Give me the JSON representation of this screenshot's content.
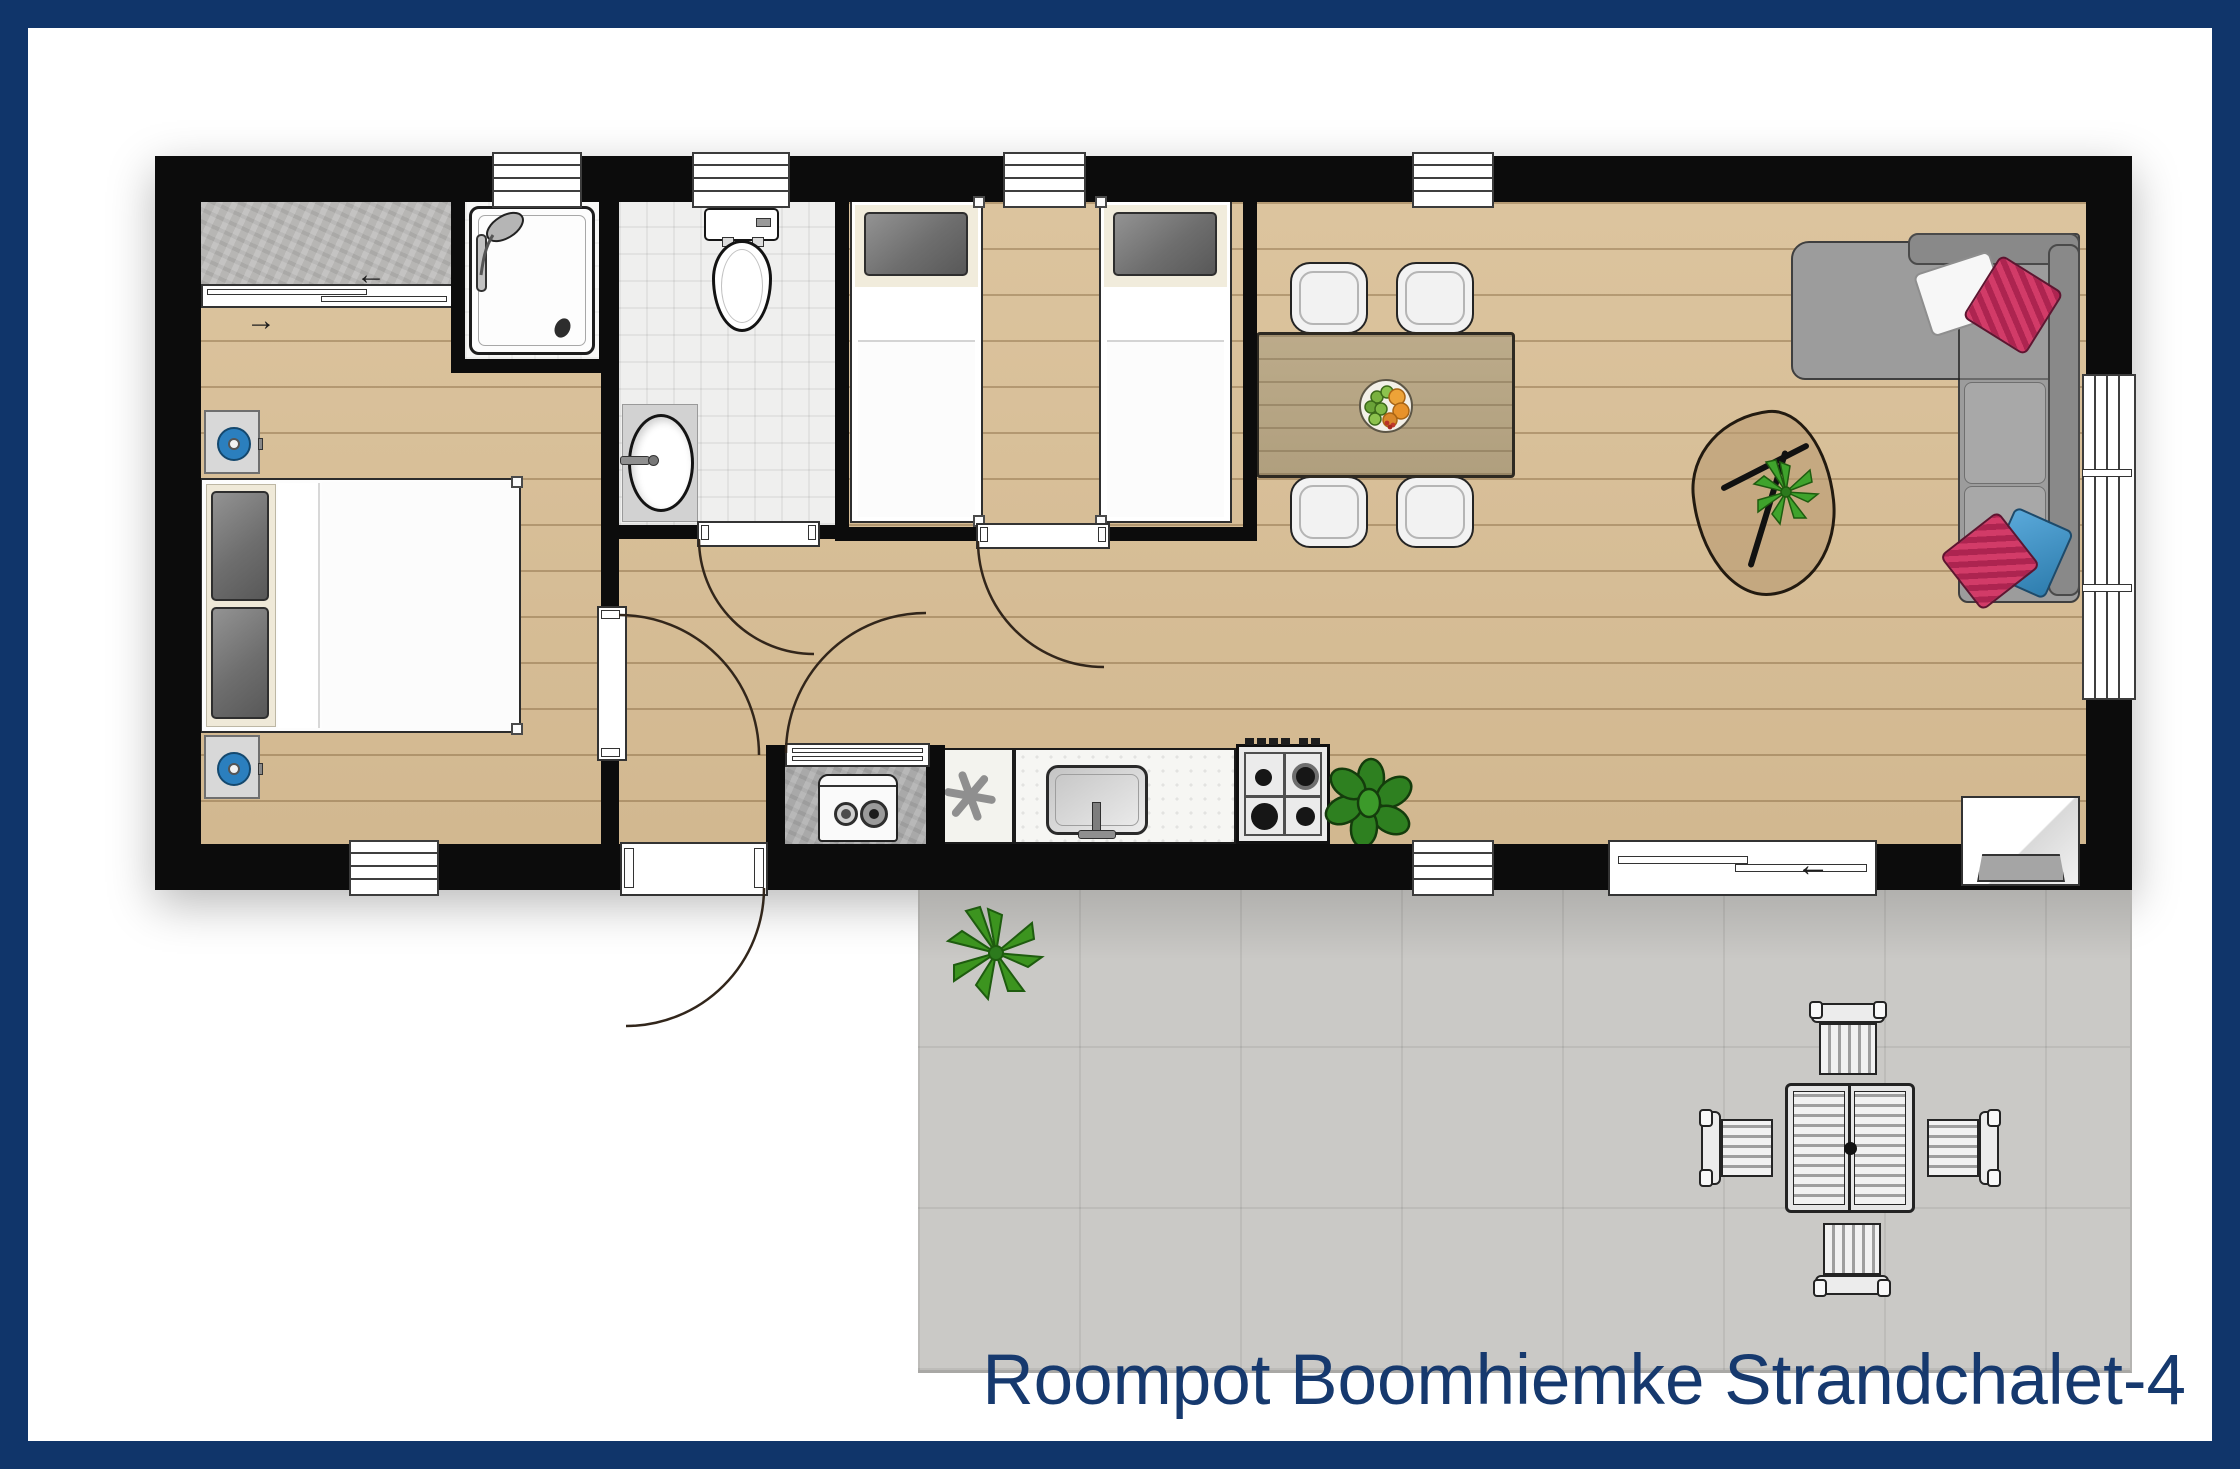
{
  "title": {
    "text": "Roompot Boomhiemke Strandchalet-4"
  },
  "colors": {
    "frame_navy": "#10356a",
    "title_navy": "#16396e",
    "wall_black": "#0c0c0c",
    "wood_floor": "#d8c098",
    "terrace_gray": "#cac9c6",
    "pillow_pink": "#d23b68",
    "pillow_blue": "#3a8fc0",
    "lamp_blue": "#2b7fbe",
    "plant_green": "#3c941f"
  },
  "icons": {
    "closet_slide_left_arrow": "←",
    "closet_slide_right_arrow": "→",
    "patio_slide_left_arrow": "←"
  }
}
